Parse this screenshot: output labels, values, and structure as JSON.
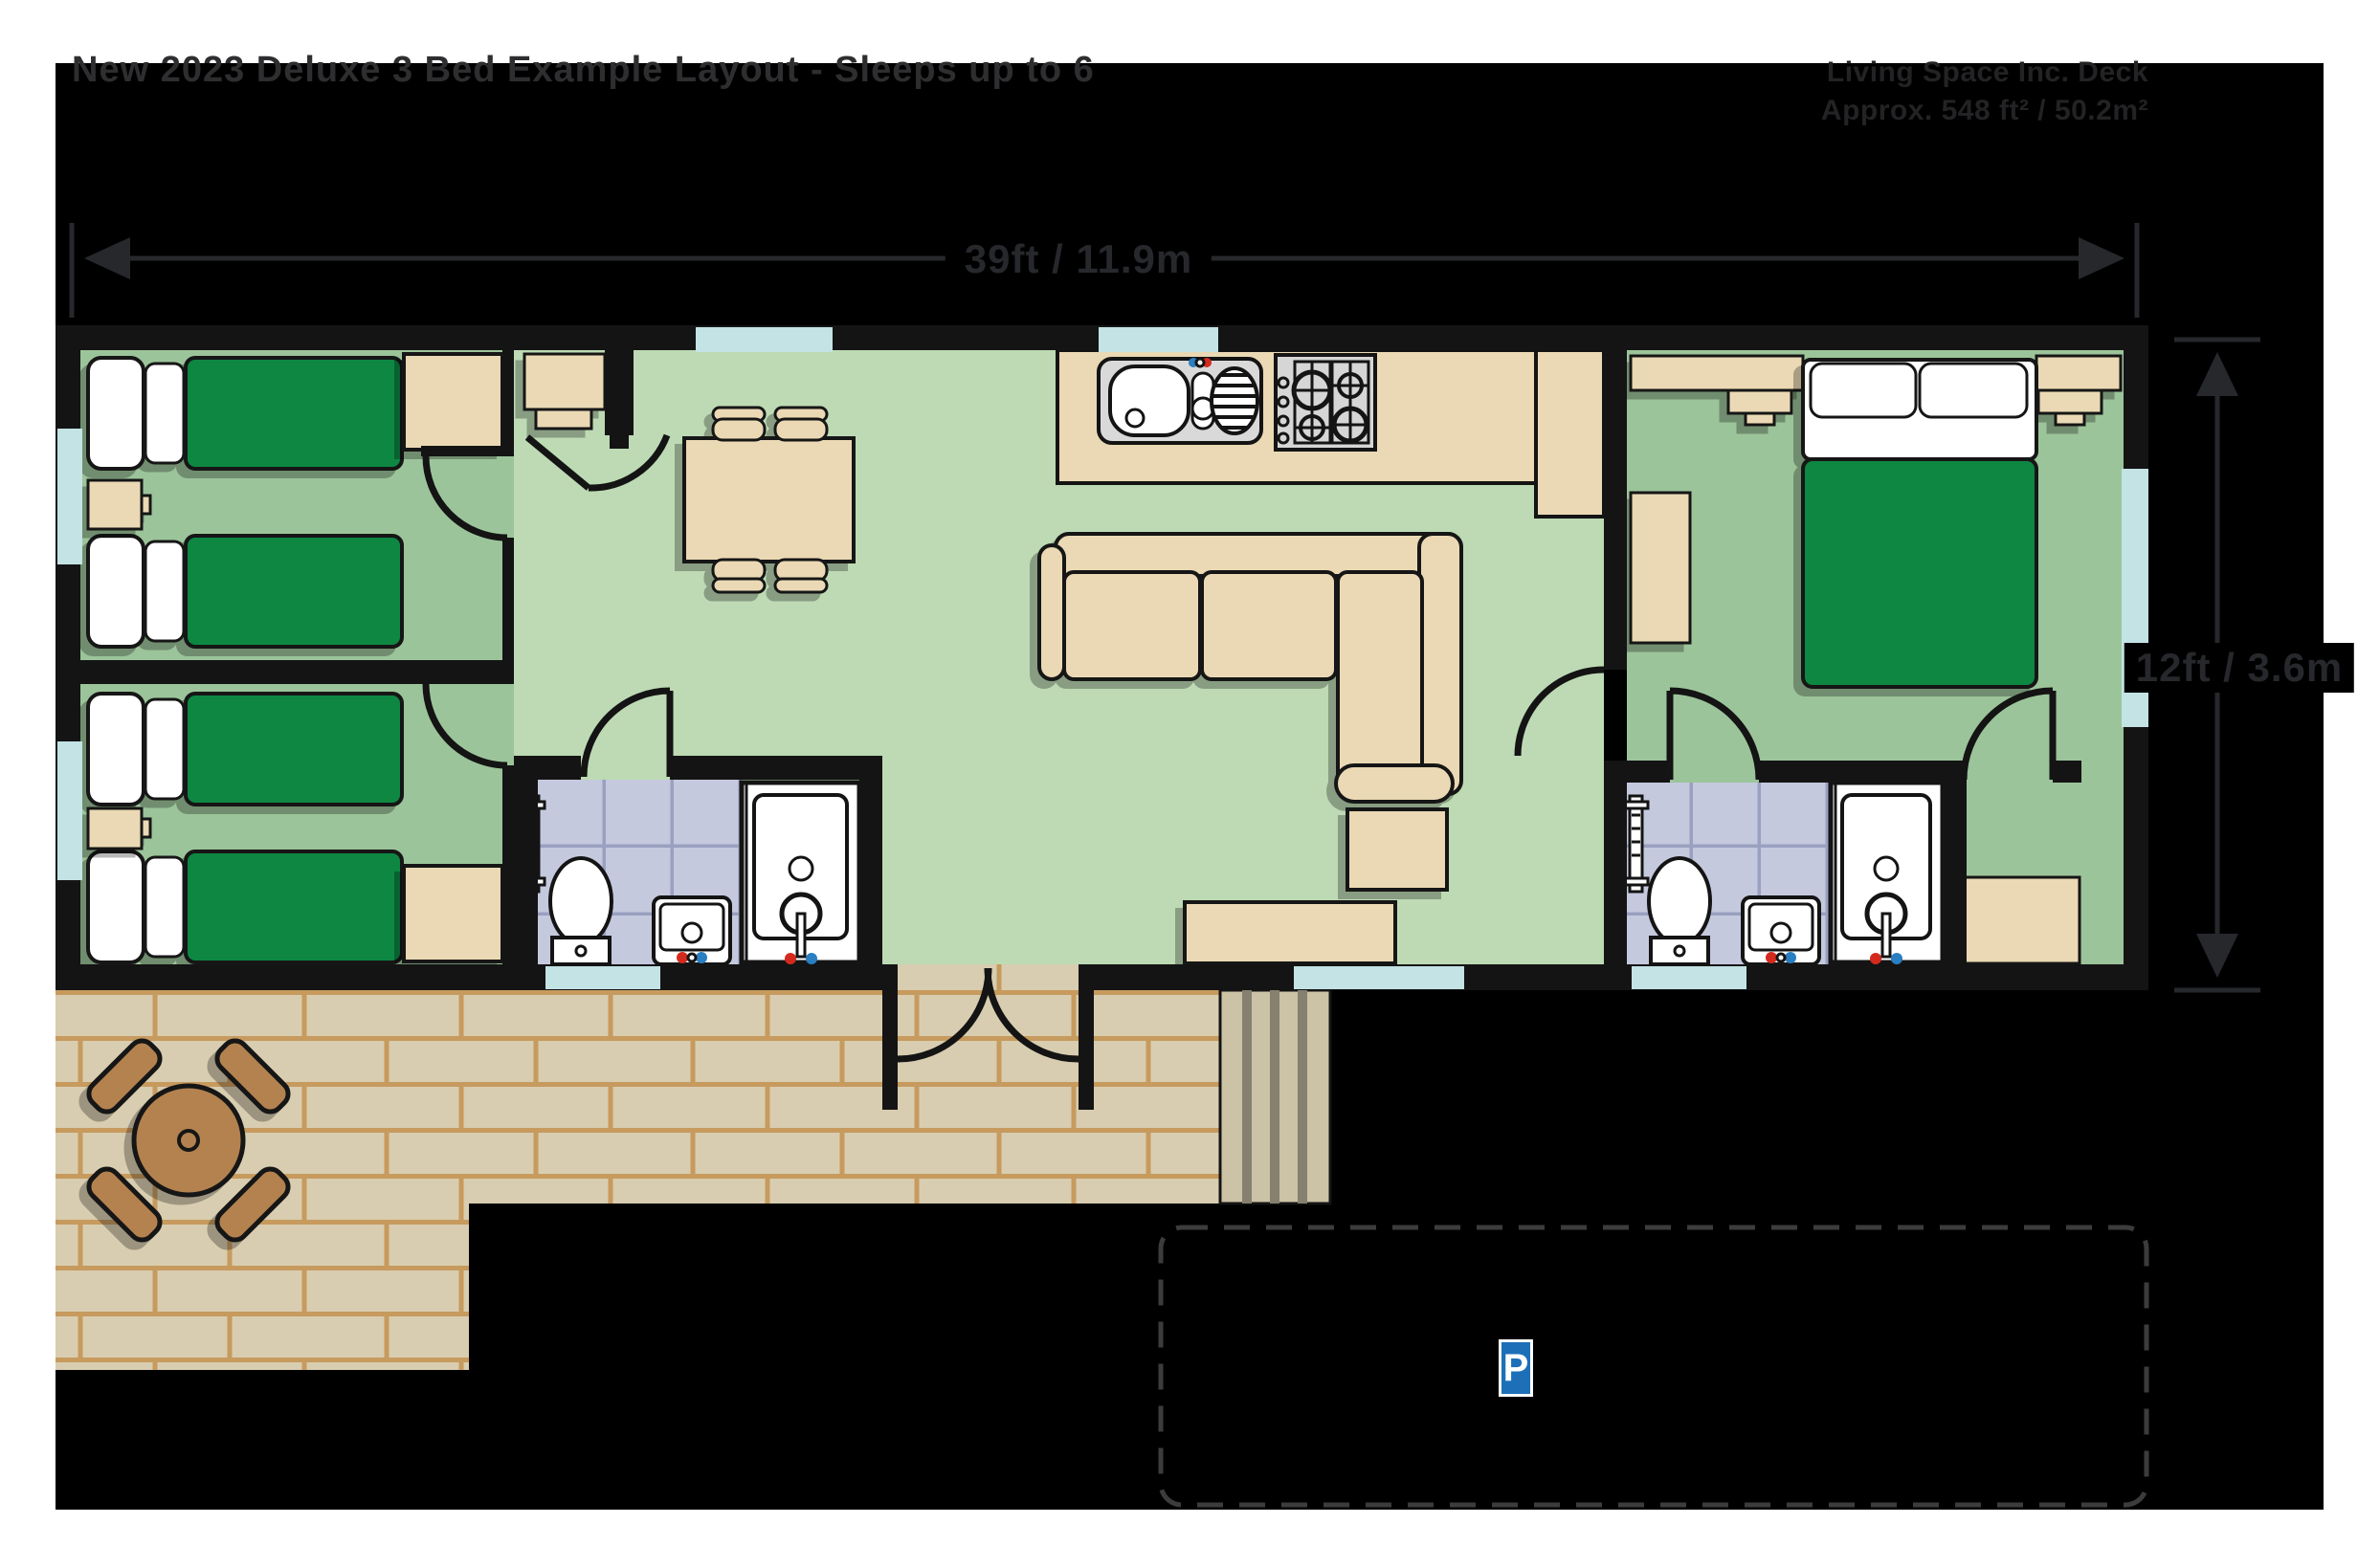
{
  "header": {
    "title": "New 2023 Deluxe 3 Bed Example Layout - Sleeps up to 6",
    "info_line1": "Living Space Inc. Deck",
    "info_line2": "Approx. 548 ft² / 50.2m²"
  },
  "dimensions": {
    "width_label": "39ft / 11.9m",
    "depth_label": "12ft / 3.6m"
  },
  "parking": {
    "sign_label": "P"
  },
  "colors": {
    "floor_living": "#bddab4",
    "floor_bedroom": "#9cc49a",
    "bed_green": "#0b8743",
    "furniture_tan": "#ead9b4",
    "tile": "#c5c9de",
    "tile_grout": "#99a0c0",
    "window_blue": "#c3e3e5",
    "deck_plank": "#d8cdb0",
    "deck_joint": "#c79a5e",
    "steps_tread": "#ccc2a6",
    "steps_gap": "#85806f",
    "wood_brown": "#b3824f",
    "parking_blue": "#1d6fb8",
    "tap_red": "#d42a1e",
    "tap_blue": "#2a7ec2",
    "dim_color": "#26282c",
    "title_color": "#2e2e30",
    "info_color": "#232325"
  }
}
